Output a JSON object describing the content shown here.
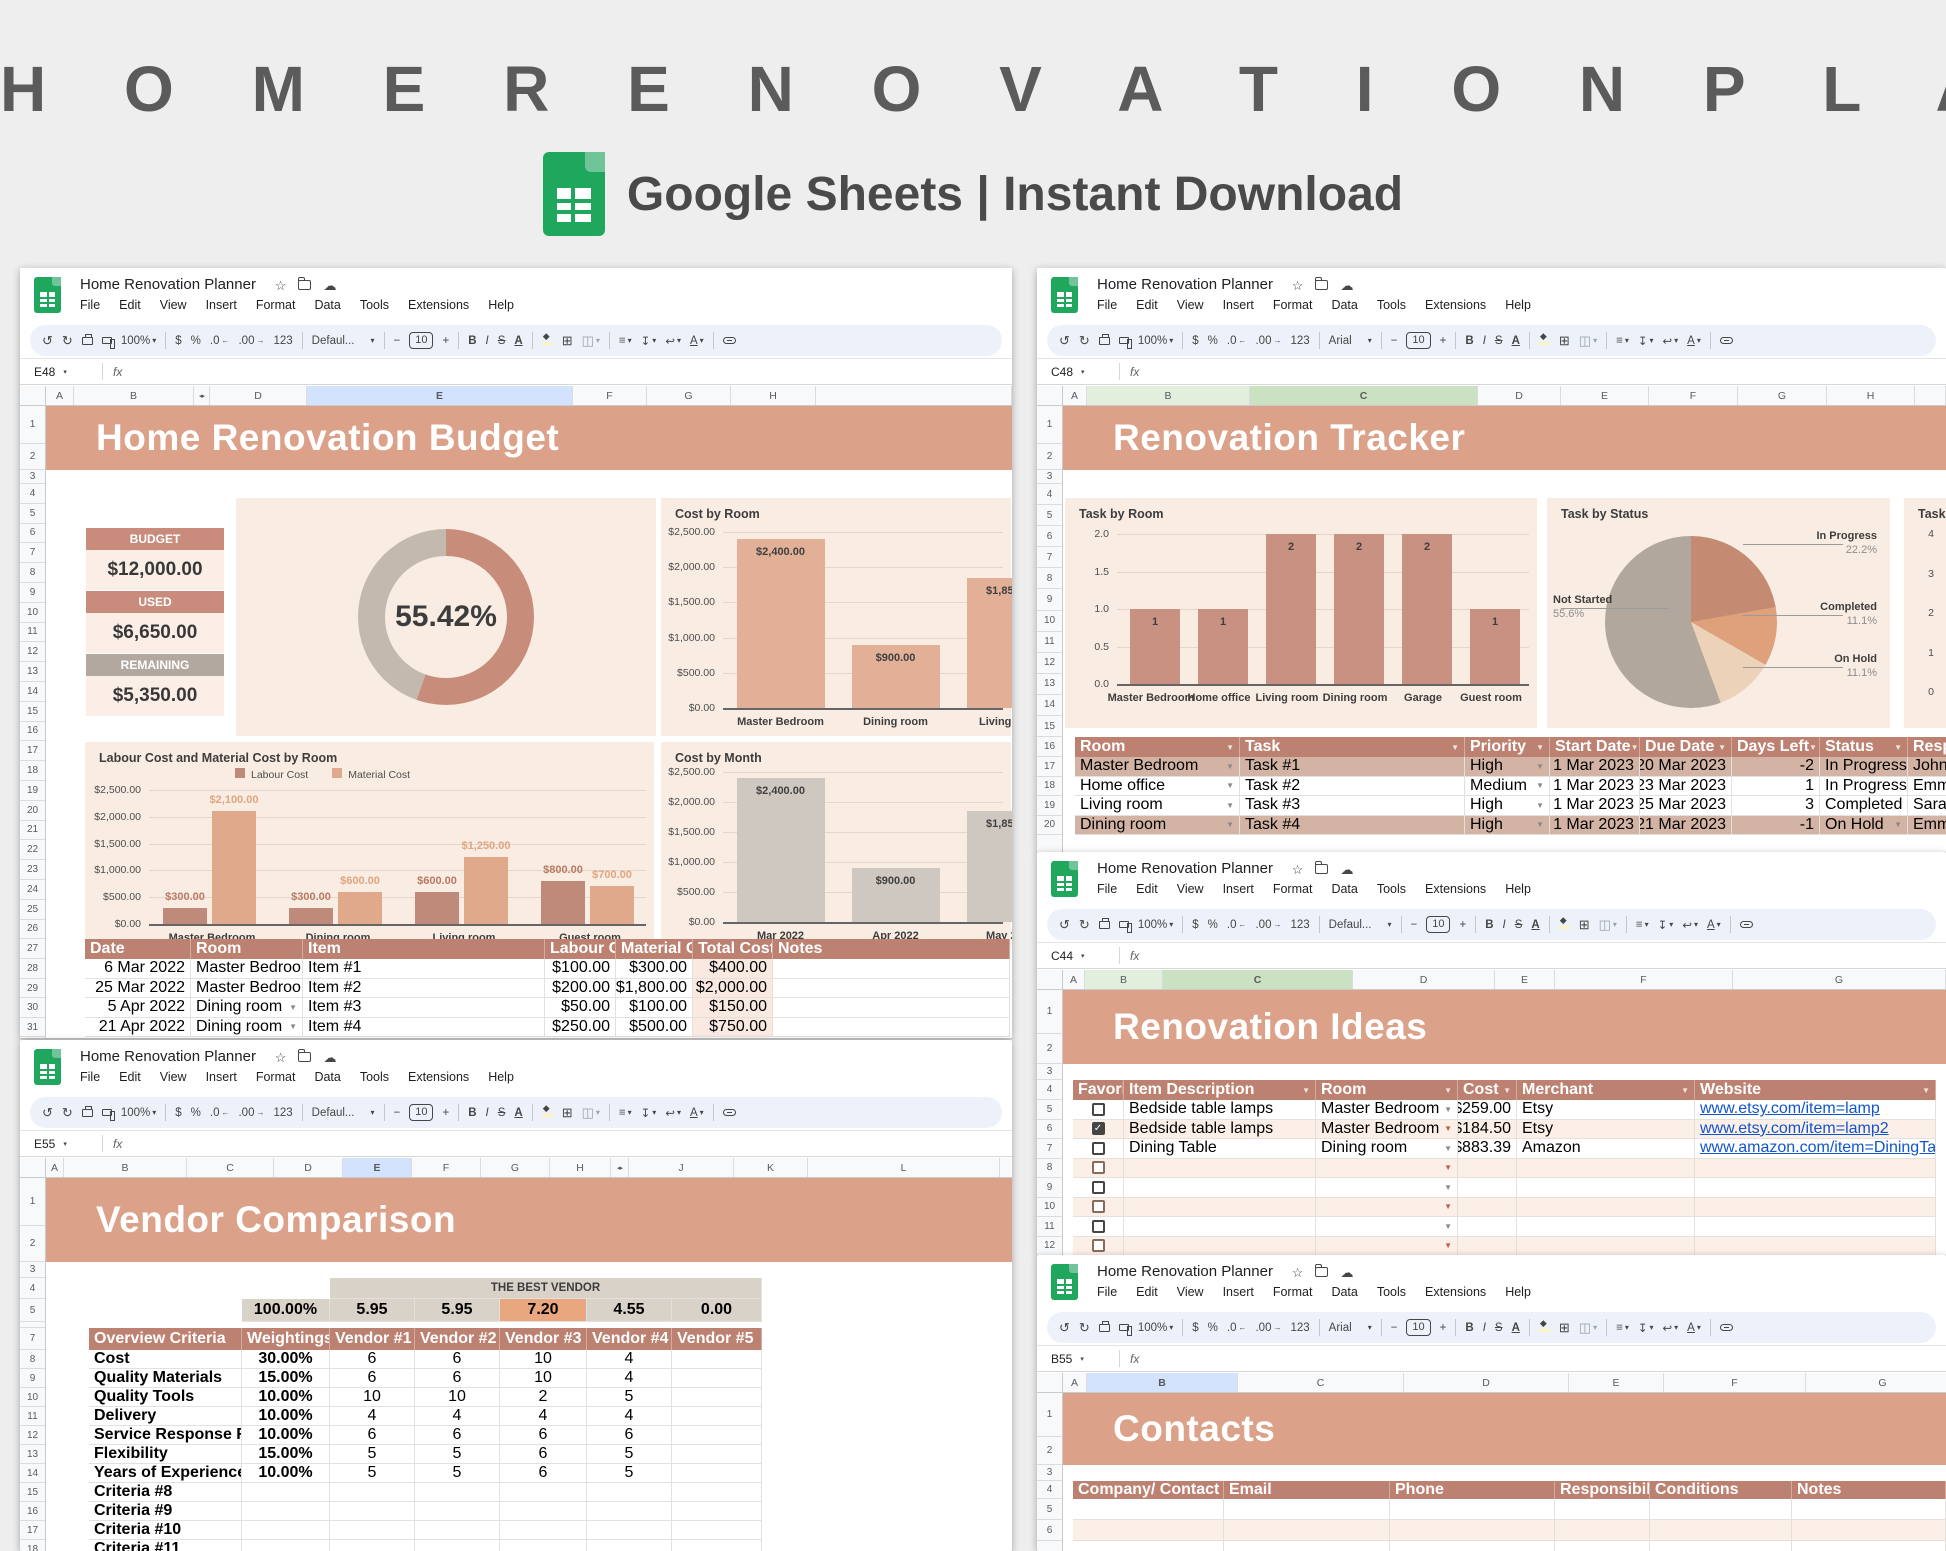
{
  "hero": {
    "title": "H O M E   R E N O V A T I O N   P L A N N E R",
    "subtitle": "Google Sheets | Instant Download"
  },
  "chrome": {
    "doc_title": "Home Renovation Planner",
    "menu": [
      "File",
      "Edit",
      "View",
      "Insert",
      "Format",
      "Data",
      "Tools",
      "Extensions",
      "Help"
    ],
    "zoom": "100%",
    "number_format_labels": [
      "$",
      "%",
      ".0",
      ".00",
      "123"
    ],
    "font_size": "10",
    "bold": "B",
    "italic": "I",
    "strike": "S",
    "text_color": "A",
    "fx": "fx"
  },
  "colors": {
    "banner_salmon": "#dca189",
    "panel_bg": "#f9ece3",
    "table_header": "#bd8171",
    "row_tint": "#fcefe7",
    "row_tan": "#d3b4a4",
    "stat_salmon": "#c98c7c",
    "stat_gray": "#b3a89f",
    "stat_value_bg": "#fbeee7",
    "best_vendor_bg": "#d8d2c9",
    "best_vendor_hl": "#e8a77e",
    "total_col_tint": "#f9e9e1",
    "link_blue": "#1155cc",
    "sel_blue": "#d3e3fd",
    "sel_green": "#cbe2c2",
    "sel_green_light": "#e3efdd"
  },
  "windows": {
    "budget": {
      "name_box": "E48",
      "font_name": "Defaul...",
      "columns": [
        "A",
        "B",
        "◂▸",
        "D",
        "E",
        "F",
        "G",
        "H"
      ],
      "selected_col": "E",
      "banner": "Home Renovation Budget",
      "stats": [
        {
          "label": "BUDGET",
          "value": "$12,000.00",
          "style": "salmon"
        },
        {
          "label": "USED",
          "value": "$6,650.00",
          "style": "salmon"
        },
        {
          "label": "REMAINING",
          "value": "$5,350.00",
          "style": "gray"
        }
      ],
      "table": {
        "headers": [
          "Date",
          "Room",
          "Item",
          "Labour Cost",
          "Material Cost",
          "Total Cost",
          "Notes"
        ],
        "rows": [
          [
            "6 Mar 2022",
            "Master Bedroom",
            "Item #1",
            "$100.00",
            "$300.00",
            "$400.00",
            ""
          ],
          [
            "25 Mar 2022",
            "Master Bedroom",
            "Item #2",
            "$200.00",
            "$1,800.00",
            "$2,000.00",
            ""
          ],
          [
            "5 Apr 2022",
            "Dining room",
            "Item #3",
            "$50.00",
            "$100.00",
            "$150.00",
            ""
          ],
          [
            "21 Apr 2022",
            "Dining room",
            "Item #4",
            "$250.00",
            "$500.00",
            "$750.00",
            ""
          ]
        ]
      }
    },
    "tracker": {
      "name_box": "C48",
      "font_name": "Arial",
      "columns": [
        "A",
        "B",
        "C",
        "D",
        "E",
        "F",
        "G",
        "H"
      ],
      "selected_col": "C",
      "banner": "Renovation Tracker",
      "table": {
        "headers": [
          "Room",
          "Task",
          "Priority",
          "Start Date",
          "Due Date",
          "Days Left",
          "Status",
          "Responsible"
        ],
        "rows": [
          {
            "room": "Master Bedroom",
            "task": "Task #1",
            "priority": "High",
            "start": "1 Mar 2023",
            "due": "20 Mar 2023",
            "days_left": "-2",
            "status": "In Progress",
            "responsible": "John",
            "tan": true
          },
          {
            "room": "Home office",
            "task": "Task #2",
            "priority": "Medium",
            "start": "1 Mar 2023",
            "due": "23 Mar 2023",
            "days_left": "1",
            "status": "In Progress",
            "responsible": "Emma",
            "tan": false
          },
          {
            "room": "Living room",
            "task": "Task #3",
            "priority": "High",
            "start": "1 Mar 2023",
            "due": "25 Mar 2023",
            "days_left": "3",
            "status": "Completed",
            "responsible": "Sarah",
            "tan": false
          },
          {
            "room": "Dining room",
            "task": "Task #4",
            "priority": "High",
            "start": "1 Mar 2023",
            "due": "21 Mar 2023",
            "days_left": "-1",
            "status": "On Hold",
            "responsible": "Emma",
            "tan": true
          }
        ]
      }
    },
    "ideas": {
      "name_box": "C44",
      "font_name": "Defaul...",
      "columns": [
        "A",
        "B",
        "C",
        "D",
        "E",
        "F",
        "G"
      ],
      "selected_col": "C",
      "banner": "Renovation Ideas",
      "table": {
        "headers": [
          "Favorite",
          "Item Description",
          "Room",
          "Cost",
          "Merchant",
          "Website"
        ],
        "rows": [
          {
            "favorite": false,
            "item": "Bedside table lamps",
            "room": "Master Bedroom",
            "cost": "$259.00",
            "merchant": "Etsy",
            "website": "www.etsy.com/item=lamp",
            "tint": false
          },
          {
            "favorite": true,
            "item": "Bedside table lamps",
            "room": "Master Bedroom",
            "cost": "$184.50",
            "merchant": "Etsy",
            "website": "www.etsy.com/item=lamp2",
            "tint": true
          },
          {
            "favorite": false,
            "item": "Dining Table",
            "room": "Dining room",
            "cost": "$883.39",
            "merchant": "Amazon",
            "website": "www.amazon.com/item=DiningTable",
            "tint": false
          },
          {
            "favorite": false,
            "item": "",
            "room": "",
            "cost": "",
            "merchant": "",
            "website": "",
            "tint": true
          },
          {
            "favorite": false,
            "item": "",
            "room": "",
            "cost": "",
            "merchant": "",
            "website": "",
            "tint": false
          },
          {
            "favorite": false,
            "item": "",
            "room": "",
            "cost": "",
            "merchant": "",
            "website": "",
            "tint": true
          },
          {
            "favorite": false,
            "item": "",
            "room": "",
            "cost": "",
            "merchant": "",
            "website": "",
            "tint": false
          },
          {
            "favorite": false,
            "item": "",
            "room": "",
            "cost": "",
            "merchant": "",
            "website": "",
            "tint": true
          }
        ]
      }
    },
    "vendor": {
      "name_box": "E55",
      "font_name": "Defaul...",
      "columns": [
        "A",
        "B",
        "C",
        "D",
        "E",
        "F",
        "G",
        "H",
        "◂▸",
        "J",
        "K",
        "L"
      ],
      "selected_col": "E",
      "banner": "Vendor Comparison",
      "best_vendor_label": "THE BEST VENDOR",
      "score_row": [
        "100.00%",
        "5.95",
        "5.95",
        "7.20",
        "4.55",
        "0.00"
      ],
      "best_score_index": 3,
      "table": {
        "headers": [
          "Overview Criteria",
          "Weightings",
          "Vendor #1",
          "Vendor #2",
          "Vendor #3",
          "Vendor #4",
          "Vendor #5"
        ],
        "rows": [
          [
            "Cost",
            "30.00%",
            "6",
            "6",
            "10",
            "4",
            ""
          ],
          [
            "Quality Materials",
            "15.00%",
            "6",
            "6",
            "10",
            "4",
            ""
          ],
          [
            "Quality Tools",
            "10.00%",
            "10",
            "10",
            "2",
            "5",
            ""
          ],
          [
            "Delivery",
            "10.00%",
            "4",
            "4",
            "4",
            "4",
            ""
          ],
          [
            "Service Response Rate",
            "10.00%",
            "6",
            "6",
            "6",
            "6",
            ""
          ],
          [
            "Flexibility",
            "15.00%",
            "5",
            "5",
            "6",
            "5",
            ""
          ],
          [
            "Years of Experience",
            "10.00%",
            "5",
            "5",
            "6",
            "5",
            ""
          ],
          [
            "Criteria #8",
            "",
            "",
            "",
            "",
            "",
            ""
          ],
          [
            "Criteria #9",
            "",
            "",
            "",
            "",
            "",
            ""
          ],
          [
            "Criteria #10",
            "",
            "",
            "",
            "",
            "",
            ""
          ],
          [
            "Criteria #11",
            "",
            "",
            "",
            "",
            "",
            ""
          ]
        ]
      }
    },
    "contacts": {
      "name_box": "B55",
      "font_name": "Arial",
      "columns": [
        "A",
        "B",
        "C",
        "D",
        "E",
        "F",
        "G"
      ],
      "selected_col": "B",
      "banner": "Contacts",
      "table": {
        "headers": [
          "Company/ Contact Name",
          "Email",
          "Phone",
          "Responsibilities",
          "Conditions",
          "Notes"
        ],
        "rows": [
          {
            "tint": false
          },
          {
            "tint": true
          },
          {
            "tint": false
          }
        ]
      }
    }
  },
  "chart_data": [
    {
      "id": "budget_donut",
      "type": "pie",
      "donut": true,
      "labels": [
        "Used",
        "Remaining"
      ],
      "values": [
        55.42,
        44.58
      ],
      "center_label": "55.42%",
      "colors": [
        "#c78d7a",
        "#c3b9ae"
      ]
    },
    {
      "id": "cost_by_room",
      "type": "bar",
      "title": "Cost by Room",
      "categories": [
        "Master Bedroom",
        "Dining room",
        "Living room"
      ],
      "values": [
        2400,
        900,
        1850
      ],
      "data_labels": [
        "$2,400.00",
        "$900.00",
        "$1,850.00"
      ],
      "yticks": [
        "$2,500.00",
        "$2,000.00",
        "$1,500.00",
        "$1,000.00",
        "$500.00",
        "$0.00"
      ],
      "ylim": [
        0,
        2500
      ],
      "bar_color": "#e2af97"
    },
    {
      "id": "labour_material_by_room",
      "type": "bar",
      "title": "Labour Cost and Material Cost by Room",
      "categories": [
        "Master Bedroom",
        "Dining room",
        "Living room",
        "Guest room"
      ],
      "series": [
        {
          "name": "Labour Cost",
          "color": "#bf8a79",
          "label_color": "#b97a63",
          "values": [
            300,
            300,
            600,
            800
          ],
          "data_labels": [
            "$300.00",
            "$300.00",
            "$600.00",
            "$800.00"
          ]
        },
        {
          "name": "Material Cost",
          "color": "#e0a98b",
          "label_color": "#dfa57e",
          "values": [
            2100,
            600,
            1250,
            700
          ],
          "data_labels": [
            "$2,100.00",
            "$600.00",
            "$1,250.00",
            "$700.00"
          ]
        }
      ],
      "yticks": [
        "$2,500.00",
        "$2,000.00",
        "$1,500.00",
        "$1,000.00",
        "$500.00",
        "$0.00"
      ],
      "ylim": [
        0,
        2500
      ],
      "legend_position": "top"
    },
    {
      "id": "cost_by_month",
      "type": "bar",
      "title": "Cost by Month",
      "categories": [
        "Mar 2022",
        "Apr 2022",
        "May 2022"
      ],
      "values": [
        2400,
        900,
        1850
      ],
      "data_labels": [
        "$2,400.00",
        "$900.00",
        "$1,850.00"
      ],
      "yticks": [
        "$2,500.00",
        "$2,000.00",
        "$1,500.00",
        "$1,000.00",
        "$500.00",
        "$0.00"
      ],
      "ylim": [
        0,
        2500
      ],
      "bar_color": "#cfc8c0"
    },
    {
      "id": "task_by_room",
      "type": "bar",
      "title": "Task by Room",
      "categories": [
        "Master Bedroom",
        "Home office",
        "Living room",
        "Dining room",
        "Garage",
        "Guest room"
      ],
      "values": [
        1,
        1,
        2,
        2,
        2,
        1
      ],
      "data_labels": [
        "1",
        "1",
        "2",
        "2",
        "2",
        "1"
      ],
      "yticks": [
        "2.0",
        "1.5",
        "1.0",
        "0.5",
        "0.0"
      ],
      "ylim": [
        0,
        2
      ],
      "bar_color": "#c99181"
    },
    {
      "id": "task_by_status",
      "type": "pie",
      "title": "Task by Status",
      "labels": [
        "In Progress",
        "Completed",
        "On Hold",
        "Not Started"
      ],
      "values": [
        22.2,
        11.1,
        11.1,
        55.6
      ],
      "pct_labels": [
        "22.2%",
        "11.1%",
        "11.1%",
        "55.6%"
      ],
      "colors": [
        "#c58a72",
        "#dfa07c",
        "#ecd2b9",
        "#b2a79c"
      ]
    },
    {
      "id": "task_partial",
      "type": "bar",
      "title": "Task",
      "categories": [],
      "values": [],
      "yticks": [
        "4",
        "3",
        "2",
        "1",
        "0"
      ],
      "ylim": [
        0,
        4
      ]
    }
  ]
}
